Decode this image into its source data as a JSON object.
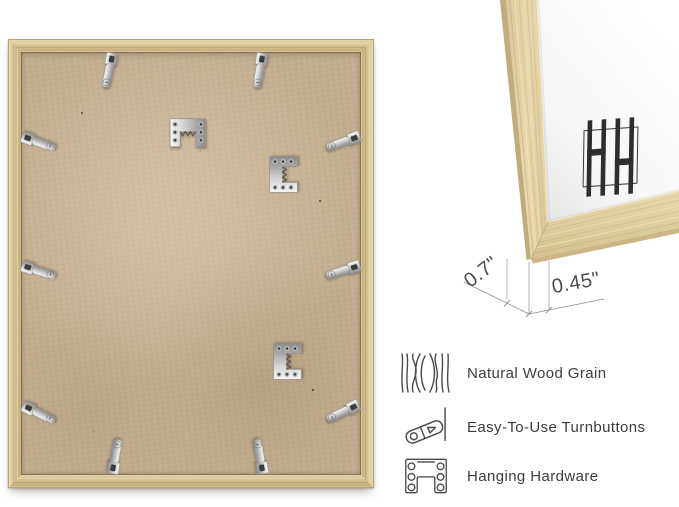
{
  "detail_view": {
    "depth_label": "0.7\"",
    "width_label": "0.45\"",
    "logo": "HH monogram"
  },
  "features": [
    {
      "icon": "wood-grain-icon",
      "label": "Natural Wood Grain"
    },
    {
      "icon": "turnbutton-icon",
      "label": "Easy-To-Use Turnbuttons"
    },
    {
      "icon": "hanging-hardware-icon",
      "label": "Hanging Hardware"
    }
  ],
  "hardware": {
    "turnbutton_count": 10,
    "sawtooth_hanger_count": 3
  },
  "colors": {
    "background": "#ffffff",
    "frame_wood": "#d4be8e",
    "frame_wood_light": "#e6d5ab",
    "mdf_board": "#c3ad8f",
    "hardware_silver": "#d6d6d6",
    "detail_wood": "#e4d3a9",
    "logo_ink": "#2e2e2e",
    "dimension_line": "#adadad",
    "text": "#3d3d3d"
  }
}
